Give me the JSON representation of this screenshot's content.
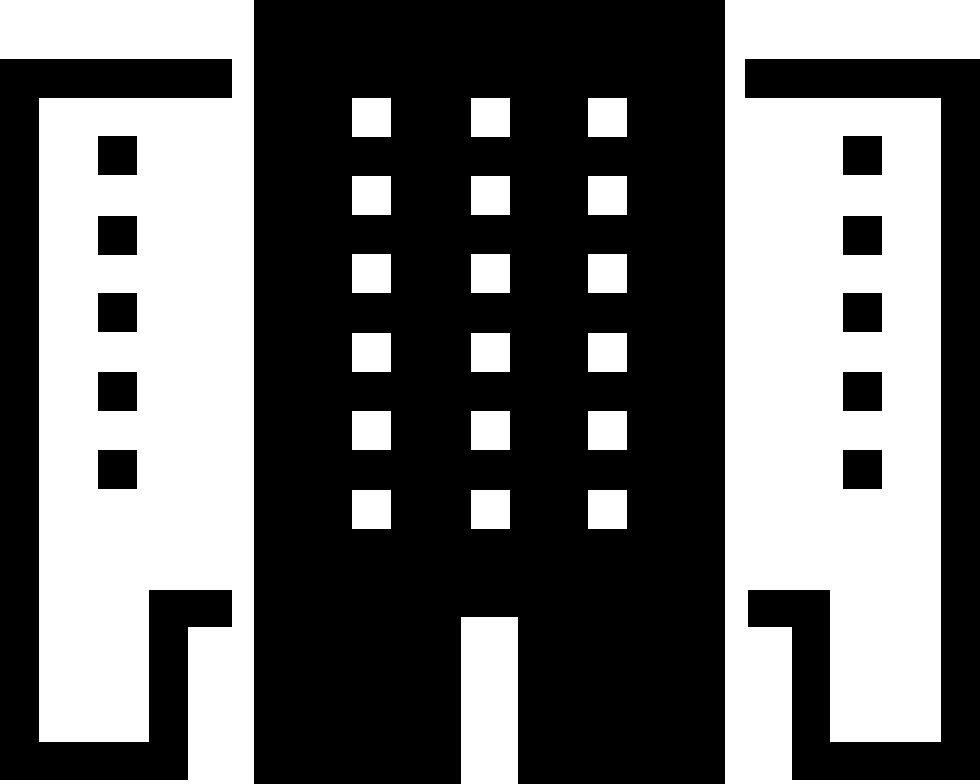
{
  "icon": {
    "name": "office-buildings",
    "description": "Solid black-and-white pictogram of a tall central office tower flanked by two outlined side buildings",
    "colors": {
      "foreground": "#000000",
      "background": "#ffffff"
    },
    "buildings": [
      {
        "id": "center-building",
        "fill": "#000000",
        "windows": {
          "color": "#ffffff",
          "width": 39,
          "height": 39,
          "columns_x": [
            352,
            471,
            588
          ],
          "rows_y": [
            98,
            176,
            254,
            333,
            411,
            490
          ]
        },
        "door": {
          "color": "#ffffff",
          "present": true
        }
      },
      {
        "id": "left-building",
        "fill": "#ffffff",
        "outline": "#000000",
        "windows": {
          "color": "#000000",
          "width": 39,
          "height": 39,
          "columns_x": [
            98
          ],
          "rows_y": [
            136,
            216,
            293,
            372,
            450
          ]
        }
      },
      {
        "id": "right-building",
        "fill": "#ffffff",
        "outline": "#000000",
        "windows": {
          "color": "#000000",
          "width": 39,
          "height": 39,
          "columns_x": [
            843
          ],
          "rows_y": [
            136,
            216,
            293,
            372,
            450
          ]
        }
      }
    ]
  }
}
